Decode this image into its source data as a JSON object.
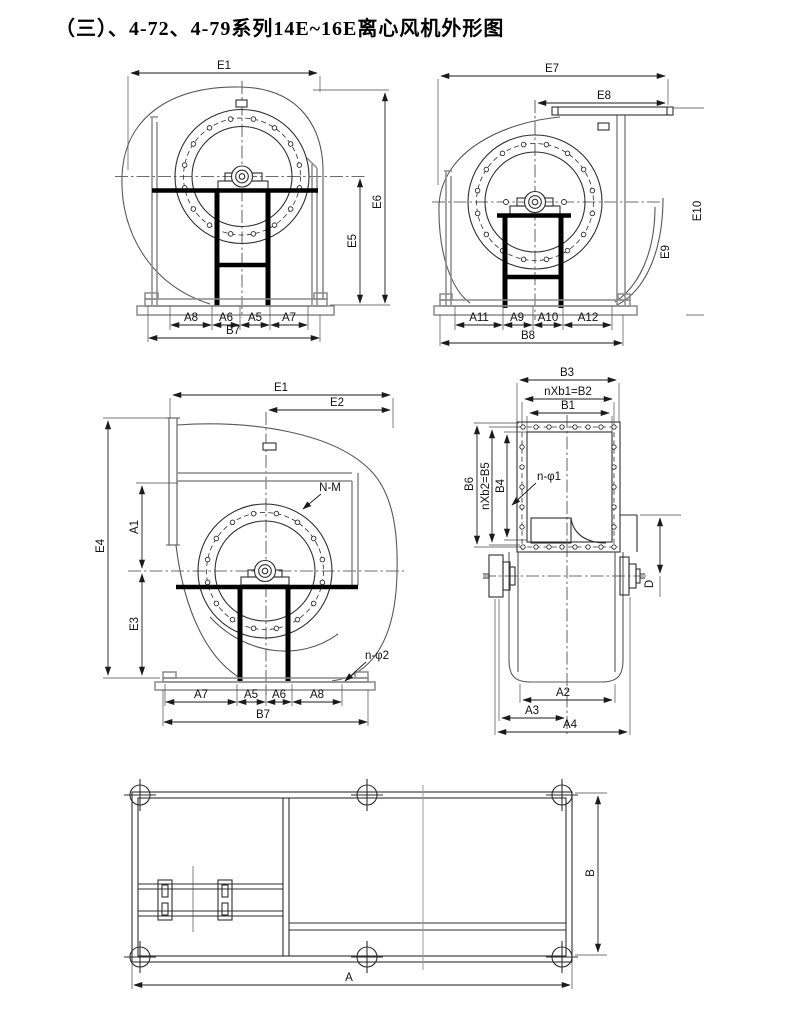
{
  "title": "（三）、4-72、4-79系列14E~16E离心风机外形图",
  "colors": {
    "line": "#2e2e2e",
    "light_line": "#8a8a8a",
    "background": "#ffffff"
  },
  "views": {
    "v1": {
      "name": "front-view-left-rotation",
      "dims": {
        "e1": "E1",
        "e6": "E6",
        "e5": "E5",
        "a8": "A8",
        "a6": "A6",
        "a5": "A5",
        "a7": "A7",
        "b7": "B7"
      }
    },
    "v2": {
      "name": "front-view-right-rotation-top-outlet",
      "dims": {
        "e7": "E7",
        "e8": "E8",
        "e10": "E10",
        "e9": "E9",
        "a11": "A11",
        "a9": "A9",
        "a10": "A10",
        "a12": "A12",
        "b8": "B8"
      }
    },
    "v3": {
      "name": "front-view-with-inlet-duct",
      "dims": {
        "e1": "E1",
        "e2": "E2",
        "e4": "E4",
        "a1": "A1",
        "e3": "E3",
        "nm": "N-M",
        "nphi2": "n-φ2",
        "a7": "A7",
        "a5": "A5",
        "a6": "A6",
        "a8": "A8",
        "b7": "B7"
      }
    },
    "v4": {
      "name": "outlet-flange-side-view",
      "dims": {
        "b3": "B3",
        "b2": "nXb1=B2",
        "b1": "B1",
        "b6": "B6",
        "b5": "nXb2=B5",
        "b4": "B4",
        "nphi1": "n-φ1",
        "d": "D",
        "a2": "A2",
        "a3": "A3",
        "a4": "A4"
      }
    },
    "v5": {
      "name": "base-frame-plan-view",
      "dims": {
        "a": "A",
        "b": "B"
      }
    }
  }
}
